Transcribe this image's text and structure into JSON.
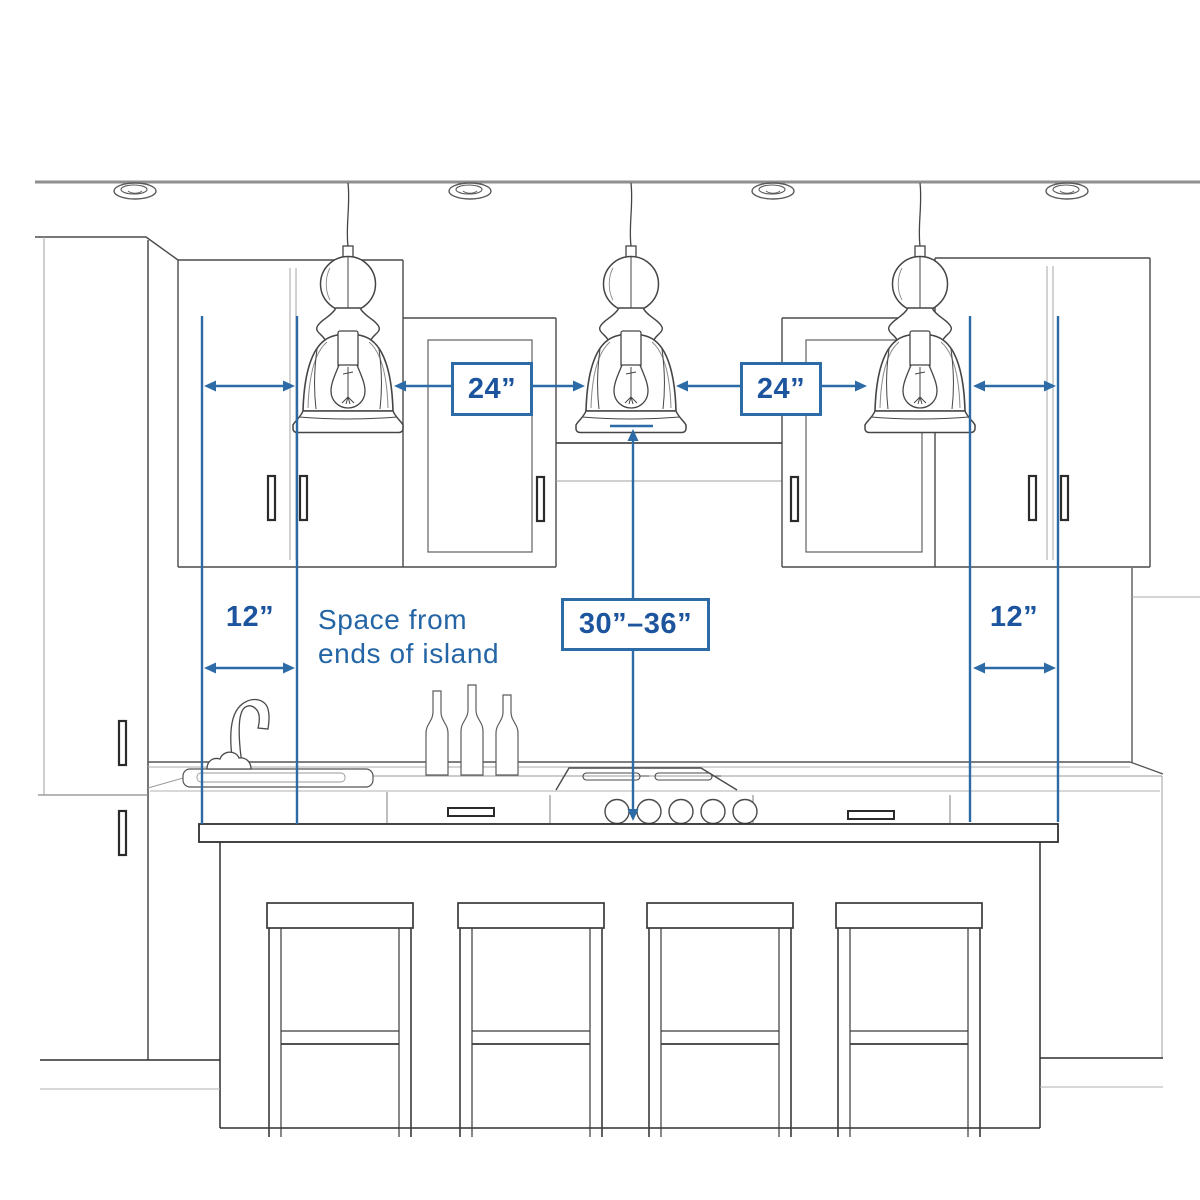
{
  "diagram": {
    "type": "kitchen-island-pendant-spacing-guide",
    "colors": {
      "dimension_line": "#2d6ba7",
      "label_text": "#1d549e",
      "sketch_dark": "#3f3f3f",
      "sketch_faint": "#a0a0a0",
      "background": "#ffffff"
    },
    "labels": {
      "spacing_left": "24”",
      "spacing_right": "24”",
      "end_clearance_left": "12”",
      "end_clearance_right": "12”",
      "height_range": "30”–36”",
      "note_line1": "Space from",
      "note_line2": "ends of island"
    }
  }
}
